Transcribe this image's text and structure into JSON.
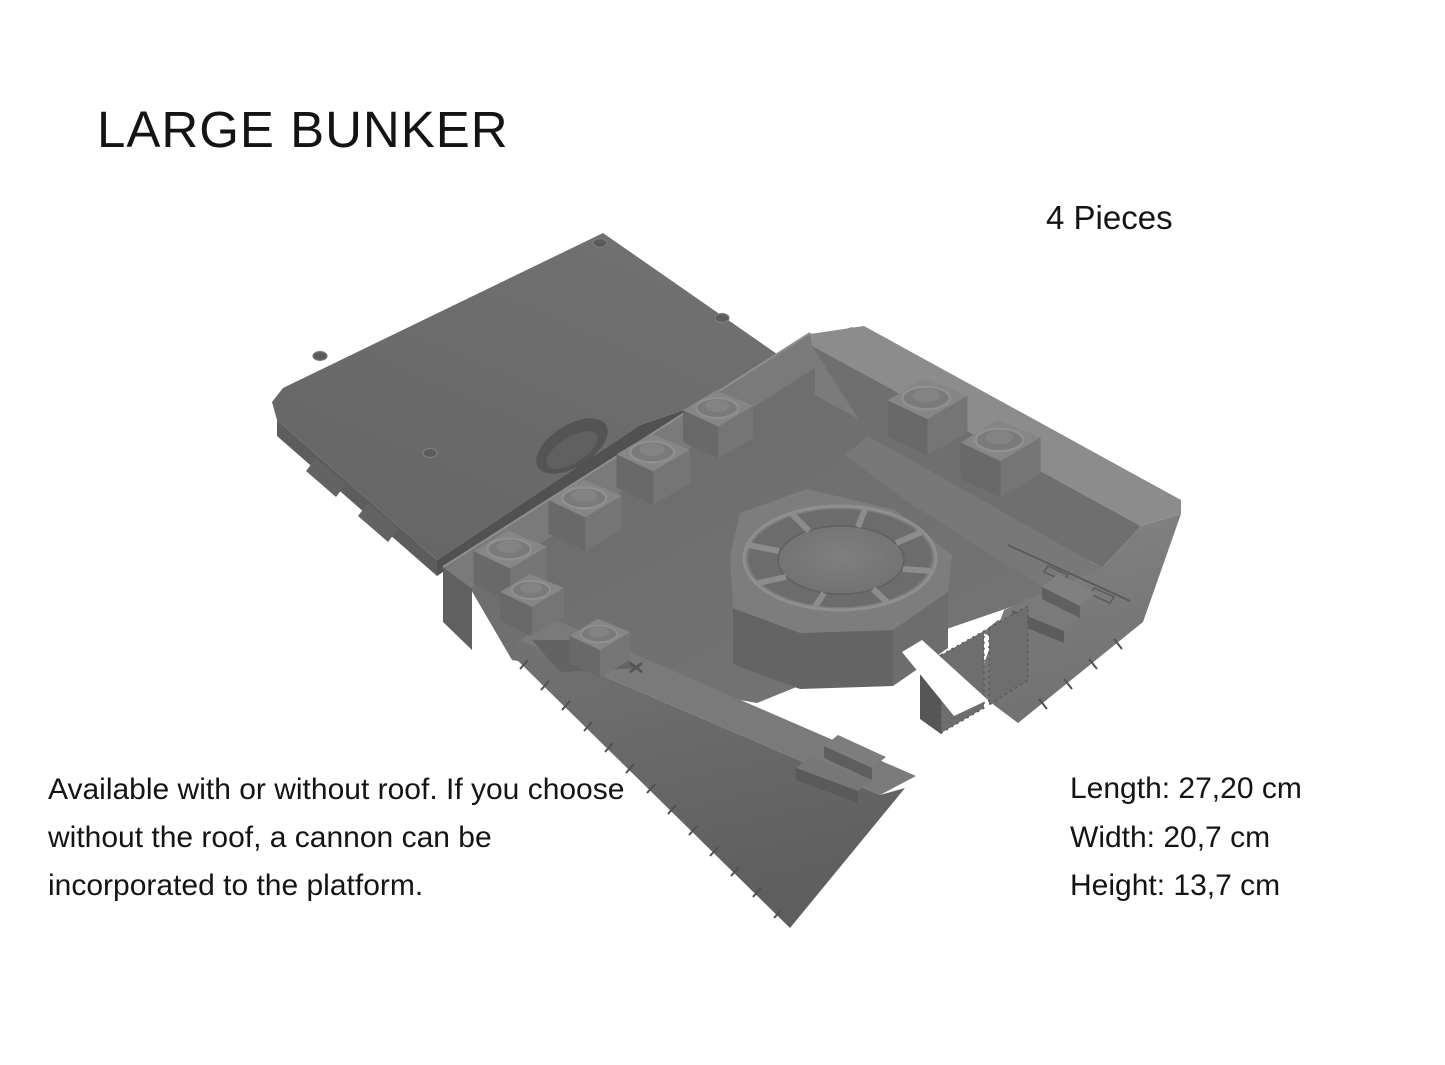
{
  "page": {
    "title": "LARGE BUNKER",
    "background_color": "#ffffff",
    "text_color": "#141414"
  },
  "product": {
    "pieces": "4 Pieces"
  },
  "description": {
    "lines": [
      "Available with or without roof. If you choose",
      "without the roof, a cannon can be",
      "incorporated to the platform."
    ]
  },
  "dimensions": {
    "length": "Length: 27,20 cm",
    "width": "Width: 20,7 cm",
    "height": "Height: 13,7 cm"
  },
  "render": {
    "subject": "large bunker 3d model, roof slab and bunker body with octagonal cannon platform",
    "colors": {
      "background": "#ffffff",
      "model_light": "#8c8c8c",
      "model_mid": "#6f6f6f",
      "model_dark": "#565656"
    }
  }
}
